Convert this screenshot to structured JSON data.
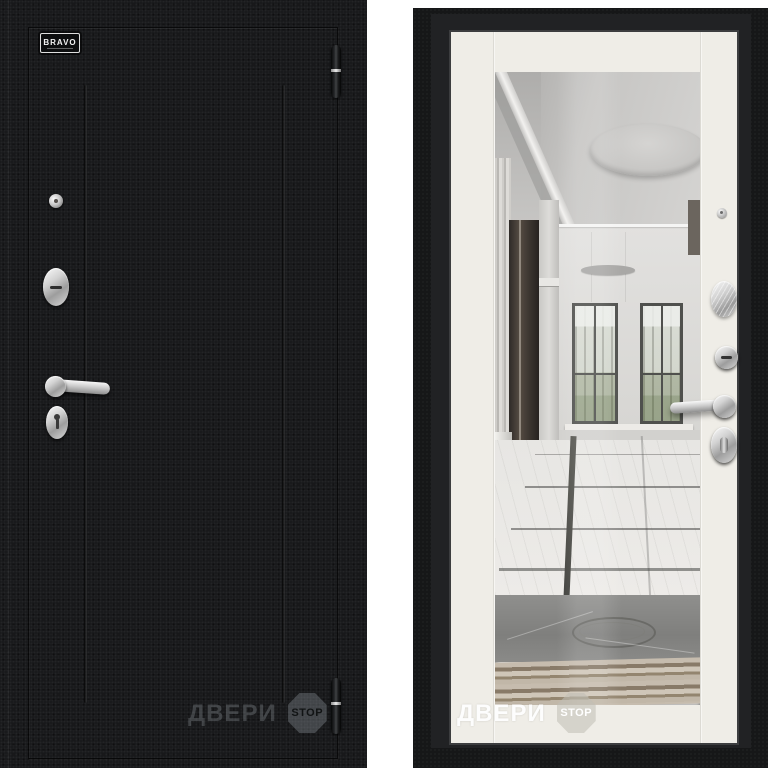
{
  "brand_badge": {
    "label": "BRAVO"
  },
  "watermarks": {
    "left": {
      "text": "ДВЕРИ",
      "badge": "STOP"
    },
    "right": {
      "text": "ДВЕРИ",
      "badge": "STOP"
    }
  },
  "icons": {
    "peephole": "peephole-lens",
    "lock_cover": "cylinder-escutcheon",
    "keyhole": "keyhole-escutcheon",
    "handle": "lever-handle",
    "hinge": "barrel-hinge",
    "thumbturn": "thumbturn-escutcheon",
    "stop_sign": "stop-octagon"
  },
  "colors": {
    "page-bg": "#ffffff",
    "door-front": "#17181a",
    "door-frame": "#161718",
    "door-leaf": "#efede7",
    "chrome-hi": "#f6f6f6",
    "chrome-lo": "#8f8f8f",
    "wm-on-black": "#3e4246",
    "wm-on-white": "#ffffff"
  }
}
